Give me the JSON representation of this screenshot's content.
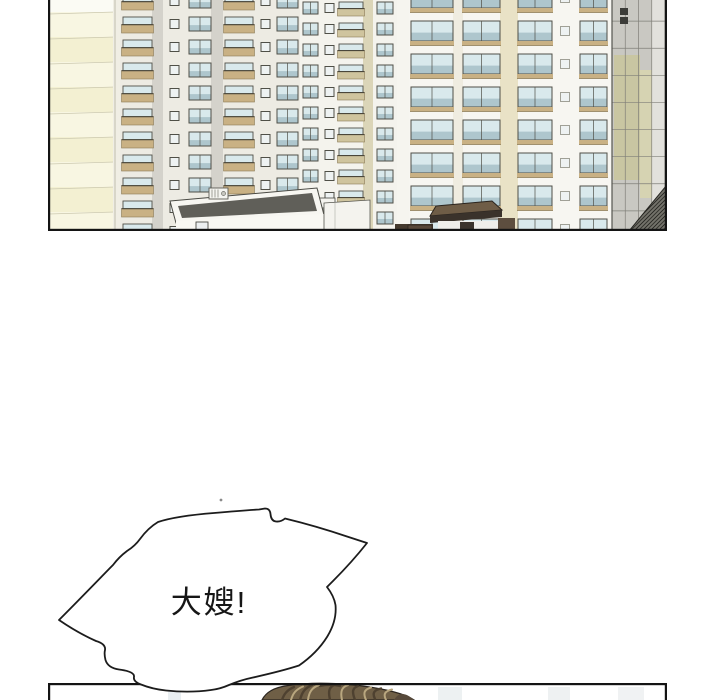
{
  "page": {
    "width": 720,
    "height": 700,
    "bg": "#ffffff"
  },
  "panels": {
    "city": {
      "x": 48,
      "y": 0,
      "w": 619,
      "h": 231,
      "border": "#141414",
      "border_w": 2.2
    },
    "bottom": {
      "x": 48,
      "y": 683,
      "w": 619,
      "h": 17,
      "border": "#141414",
      "border_w": 2.2
    }
  },
  "bubble": {
    "text": "大嫂!",
    "fill": "#ffffff",
    "stroke": "#1c1c1c",
    "stroke_w": 1.8,
    "text_color": "#161616",
    "font_size": 31,
    "letter_spacing": 2,
    "text_x": 209,
    "text_y": 613,
    "path": "M59,620 Q76,603 110,568 L113,565 Q119,557 127,551 Q135,546 140,539 Q148,528 158,522 Q176,516 214,513 Q242,510.5 259,509.5 L265,508.5 Q270,508.5 270.5,514 Q271,521 276,521.5 Q281,522 285,518.5 Q316,526 347,536.5 L367,543 Q352,562 333,581 L327,587 Q334,596 335.5,605 Q337,621 327,637 Q317,653 299,665.5 Q282,671 253,677.5 Q241,680 229,685 Q220,689 211,690 Q190,693 166,690.5 Q152,689 141,684.5 Q133,681.5 134,677 Q135,671.5 119,669.5 Q108,668 105.5,660 Q104,654 105,650 Q106,644 96,641 Q78,633 59,620 Z",
    "speck": {
      "x": 221,
      "y": 500,
      "r": 1.4,
      "color": "#8a8a8a"
    }
  },
  "head": {
    "outline": "#2c2620",
    "base": "#6f5f46",
    "dark": "#4e4130",
    "light": "#b9a77f",
    "patch": "#57493a",
    "dome": "M262,700 C266,692 274,687.5 288,685.5 C303,683.2 320,682.8 336,683.6 C354,684.4 372,687 386,690 C398,692.6 408,696 414,700 Z",
    "dark_strands": [
      "M300,700 C302,692 305,688 312,685",
      "M330,700 C328,691 329,687 335,684.5",
      "M355,700 C352,692 352,688 358,686",
      "M282,700 C284,694 287,690 294,687",
      "M375,699 C372,693 374,690 381,688.5",
      "M320,686 Q330,683.5 340,686"
    ],
    "light_strands": [
      "M308,700 C309,692 312,687.5 319,685",
      "M342,700 C340,691 342,687 348,685",
      "M366,700 C363,693 364,689.5 371,687.5",
      "M291,700 C293,693 296,689.5 303,686.5",
      "M386,700 C383,694 385,691 392,689.5"
    ],
    "patch_path": "M394,700 C398,693 404,691 414,700 Z"
  },
  "bottom_scene": {
    "faint_shapes": [
      {
        "x": 168,
        "y": 687,
        "w": 13,
        "h": 13,
        "f": "#e9eef1"
      },
      {
        "x": 438,
        "y": 687,
        "w": 24,
        "h": 13,
        "f": "#edf1f2"
      },
      {
        "x": 548,
        "y": 687,
        "w": 22,
        "h": 13,
        "f": "#eef1f2"
      },
      {
        "x": 618,
        "y": 687,
        "w": 26,
        "h": 13,
        "f": "#f0f2f3"
      }
    ]
  },
  "city": {
    "bg": "#fdfdfa",
    "colors": {
      "glass": "#d9e9ec",
      "glass2": "#aec6cd",
      "frame": "#4f4f47",
      "tan": "#c9b184",
      "tan_line": "#8a7a55",
      "rail_top": "#4a463a",
      "sq_fill": "#eef2f2"
    },
    "towers": [
      {
        "x": 251,
        "w": 115,
        "face": "#f4f3ed",
        "floor_h": 21,
        "off": 2,
        "win_h": 12,
        "stripes": [
          {
            "t": "glass",
            "x": 254,
            "w": 15
          },
          {
            "t": "sq",
            "x": 275,
            "w": 11
          },
          {
            "t": "balcony",
            "x": 290,
            "w": 24,
            "tan": "#cfc49e"
          },
          {
            "t": "panel",
            "x": 314,
            "w": 10,
            "fill": "#dbd5b8"
          },
          {
            "t": "glass",
            "x": 328,
            "w": 16
          },
          {
            "t": "panel",
            "x": 348,
            "w": 18,
            "fill": "#f6f5ef"
          }
        ]
      },
      {
        "x": 360,
        "w": 203,
        "face": "#f7f6f1",
        "floor_h": 33,
        "off": -12,
        "win_h": 20,
        "stripes": [
          {
            "t": "sill",
            "x": 362,
            "w": 42
          },
          {
            "t": "panel",
            "x": 404,
            "w": 10,
            "fill": "#efece0"
          },
          {
            "t": "sill",
            "x": 414,
            "w": 37
          },
          {
            "t": "panel",
            "x": 451,
            "w": 18,
            "fill": "#e9e2c6"
          },
          {
            "t": "sill",
            "x": 469,
            "w": 34
          },
          {
            "t": "sq",
            "x": 509,
            "w": 14,
            "light": true
          },
          {
            "t": "sill",
            "x": 531,
            "w": 27
          }
        ]
      },
      {
        "x": 69,
        "w": 182,
        "face": "#edebe3",
        "floor_h": 23,
        "off": -6,
        "win_h": 14,
        "stripes": [
          {
            "t": "balcony",
            "x": 74,
            "w": 29
          },
          {
            "t": "panel",
            "x": 103,
            "w": 11,
            "fill": "#d4d2cb"
          },
          {
            "t": "sq",
            "x": 119,
            "w": 13
          },
          {
            "t": "glass",
            "x": 140,
            "w": 22
          },
          {
            "t": "panel",
            "x": 162,
            "w": 12,
            "fill": "#d4d2cb"
          },
          {
            "t": "balcony",
            "x": 176,
            "w": 28
          },
          {
            "t": "sq",
            "x": 210,
            "w": 13
          },
          {
            "t": "glass",
            "x": 228,
            "w": 21
          }
        ]
      }
    ],
    "cream_wall": {
      "x": 0,
      "w": 66,
      "band_h": 25,
      "off": 12,
      "top_fill": "#fbfbf4",
      "fills": [
        "#f8f6e2",
        "#f3f0d2"
      ],
      "line": "#ccc9b0"
    },
    "shapes": [
      {
        "k": "rect",
        "x": 64,
        "y": 0,
        "w": 7,
        "h": 232,
        "f": "#f0eee4",
        "n": "wall-edge-strip"
      },
      {
        "k": "line",
        "x1": 66,
        "y1": 0,
        "x2": 66,
        "y2": 232,
        "s": "#b5b2a0",
        "sw": 0.8
      },
      {
        "k": "rect",
        "x": 563,
        "y": 0,
        "w": 53,
        "h": 232,
        "f": "#c9c8c2",
        "n": "grid-building-face"
      },
      {
        "k": "rect",
        "x": 565,
        "y": 55,
        "w": 26,
        "h": 125,
        "f": "#c9c6a2",
        "n": "grid-building-olive-band"
      },
      {
        "k": "rect",
        "x": 591,
        "y": 70,
        "w": 12,
        "h": 128,
        "f": "#d6d3b2",
        "n": "grid-building-olive-band-2"
      },
      {
        "k": "rect",
        "x": 603,
        "y": 0,
        "w": 13,
        "h": 232,
        "f": "#e2e1dc",
        "n": "grid-building-light-strip"
      },
      {
        "k": "grid",
        "x": 563,
        "y": -6,
        "w": 53,
        "h": 244,
        "nx": 4,
        "ny": 9,
        "s": "#807f78",
        "sw": 0.7,
        "n": "grid-facade-lines"
      },
      {
        "k": "line",
        "x1": 563,
        "y1": 0,
        "x2": 563,
        "y2": 232,
        "s": "#55554f",
        "sw": 1.2
      },
      {
        "k": "rect",
        "x": 571,
        "y": 8,
        "w": 8,
        "h": 7,
        "f": "#3c3c38",
        "n": "building-logo-mark"
      },
      {
        "k": "rect",
        "x": 571,
        "y": 17,
        "w": 8,
        "h": 7,
        "f": "#3c3c38",
        "n": "building-logo-mark"
      },
      {
        "k": "rect",
        "x": 229,
        "y": 198,
        "w": 57,
        "h": 10,
        "f": "#f4f3ee",
        "s": "#45453f",
        "sw": 0.8,
        "n": "grey-building-parapet"
      },
      {
        "k": "rect",
        "x": 229,
        "y": 208,
        "w": 57,
        "h": 23,
        "f": "#90908a",
        "n": "grey-building-wall"
      },
      {
        "k": "poly",
        "p": "121,201 268,188 275,215 127,223",
        "f": "#f7f6f1",
        "s": "#4a4a44",
        "sw": 1,
        "n": "white-building-parapet"
      },
      {
        "k": "poly",
        "p": "129,206 263,193 268,211 133,218",
        "f": "#605f59",
        "n": "white-building-roof"
      },
      {
        "k": "poly",
        "p": "127,221 275,214 275,231 127,231",
        "f": "#f9f8f3",
        "n": "white-building-wall"
      },
      {
        "k": "rect",
        "x": 147,
        "y": 222,
        "w": 12,
        "h": 9,
        "f": "#eceff0",
        "s": "#4c4c46",
        "sw": 0.9,
        "n": "white-building-door"
      },
      {
        "k": "rect",
        "x": 160,
        "y": 188,
        "w": 19,
        "h": 11,
        "f": "#f4f4f0",
        "s": "#5c5c55",
        "sw": 0.9,
        "n": "ac-unit"
      },
      {
        "k": "line",
        "x1": 163,
        "y1": 189.5,
        "x2": 163,
        "y2": 197.5,
        "s": "#8b8b83",
        "sw": 0.8
      },
      {
        "k": "line",
        "x1": 166,
        "y1": 189.5,
        "x2": 166,
        "y2": 197.5,
        "s": "#8b8b83",
        "sw": 0.8
      },
      {
        "k": "line",
        "x1": 169,
        "y1": 189.5,
        "x2": 169,
        "y2": 197.5,
        "s": "#8b8b83",
        "sw": 0.8
      },
      {
        "k": "circle",
        "cx": 174.5,
        "cy": 193.5,
        "r": 2,
        "f": "#c7c7c0",
        "s": "#6b6b64",
        "sw": 0.7,
        "n": "ac-fan"
      },
      {
        "k": "poly",
        "p": "275,203 321,200 321,231 275,231",
        "f": "#f4f3ee",
        "s": "#55554e",
        "sw": 0.8,
        "n": "white-wing-wall"
      },
      {
        "k": "line",
        "x1": 286,
        "y1": 203,
        "x2": 286,
        "y2": 231,
        "s": "#c9c8c2",
        "sw": 1
      },
      {
        "k": "rect",
        "x": 346,
        "y": 224,
        "w": 38,
        "h": 8,
        "f": "#453a2e",
        "n": "dark-roof-strip"
      },
      {
        "k": "poly",
        "p": "387,206 443,201 453,210 381,216",
        "f": "#6f5d47",
        "s": "#2a241e",
        "sw": 1,
        "n": "pavilion-roof"
      },
      {
        "k": "poly",
        "p": "381,216 453,210 453,217 381,223",
        "f": "#3a322b",
        "n": "pavilion-fascia"
      },
      {
        "k": "rect",
        "x": 389,
        "y": 221,
        "w": 60,
        "h": 11,
        "f": "#efeeea",
        "n": "pavilion-wall"
      },
      {
        "k": "rect",
        "x": 411,
        "y": 222,
        "w": 14,
        "h": 10,
        "f": "#3b342d",
        "n": "pavilion-door"
      },
      {
        "k": "rect",
        "x": 359,
        "y": 225,
        "w": 24,
        "h": 7,
        "f": "#57483a",
        "s": "#2a241e",
        "sw": 0.7,
        "n": "pavilion-left-wing"
      },
      {
        "k": "rect",
        "x": 449,
        "y": 218,
        "w": 17,
        "h": 14,
        "f": "#5d4e3f",
        "n": "pavilion-right-wing"
      },
      {
        "k": "hatch",
        "p": "580,231 617,186 617,231",
        "f": "#74736b",
        "s": "#23231f",
        "sw": 1,
        "gap": 4,
        "n": "hatched-roof"
      }
    ]
  }
}
